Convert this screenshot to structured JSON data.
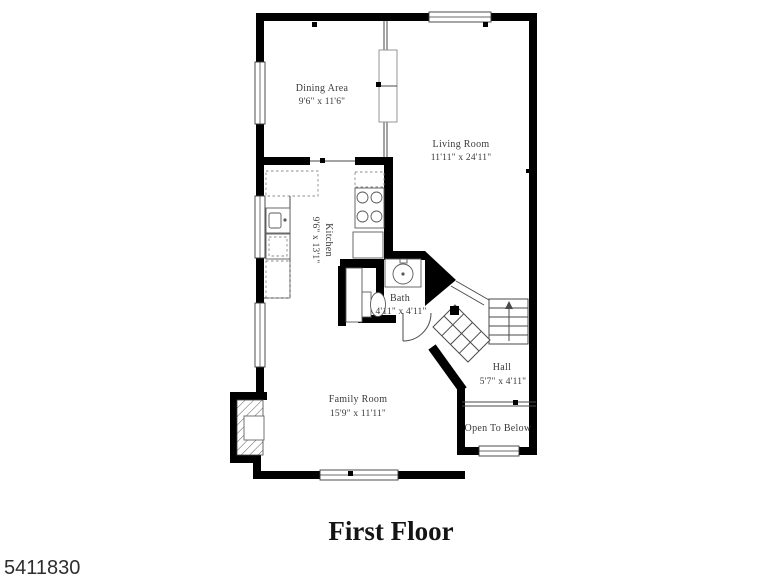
{
  "title": "First Floor",
  "watermark": "5411830",
  "colors": {
    "wall": "#000000",
    "text": "#3a3a3a"
  },
  "rooms": {
    "dining": {
      "name": "Dining Area",
      "dims": "9'6\" x 11'6\""
    },
    "living": {
      "name": "Living Room",
      "dims": "11'11\" x 24'11\""
    },
    "kitchen": {
      "name": "Kitchen",
      "dims": "9'6\" x 13'1\""
    },
    "bath": {
      "name": "Bath",
      "dims": "4'11\" x 4'11\""
    },
    "hall": {
      "name": "Hall",
      "dims": "5'7\" x 4'11\""
    },
    "family": {
      "name": "Family Room",
      "dims": "15'9\" x 11'11\""
    },
    "open_below": {
      "name": "Open To Below"
    }
  }
}
